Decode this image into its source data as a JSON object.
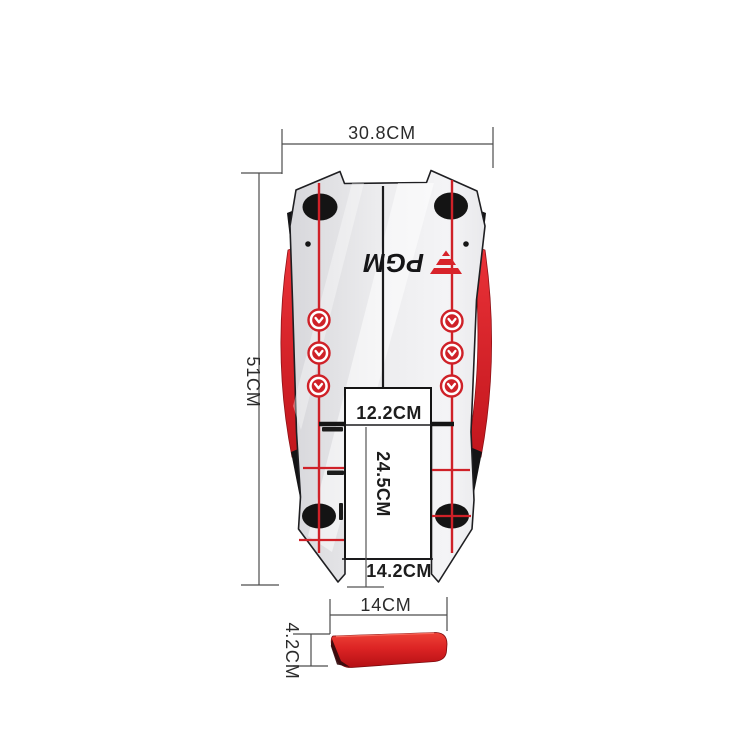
{
  "product": {
    "brand": "PGM",
    "kind": "golf-putting-alignment-mirror-diagram"
  },
  "annotations": {
    "overall_width": "30.8CM",
    "overall_length": "51CM",
    "slot_width": "12.2CM",
    "slot_length": "24.5CM",
    "bottom_gap_width": "14.2CM",
    "bar_length": "14CM",
    "bar_height": "4.2CM"
  },
  "icons": {
    "alignment_arrow": "chevron-down-in-circle"
  },
  "colors": {
    "accent_red": "#d8232a",
    "rail_red": "#e02a2e",
    "mirror_gray_light": "#f3f3f5",
    "mirror_gray_dark": "#d9d9dc",
    "trim_black": "#141416",
    "dimension_text": "#2b2b2b",
    "background": "#ffffff"
  }
}
